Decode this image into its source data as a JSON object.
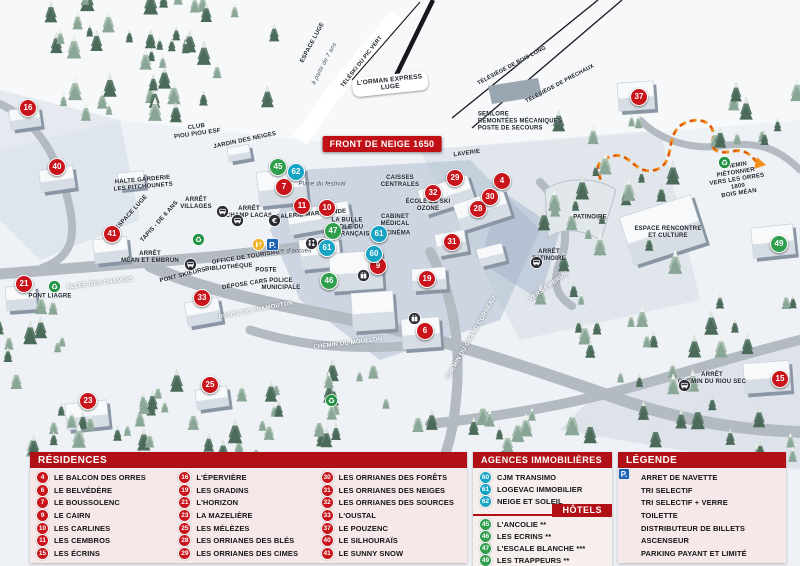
{
  "map": {
    "banner": "FRONT DE NEIGE 1650",
    "markers": [
      {
        "n": "16",
        "t": "r",
        "x": 28,
        "y": 108
      },
      {
        "n": "40",
        "t": "r",
        "x": 57,
        "y": 167
      },
      {
        "n": "41",
        "t": "r",
        "x": 112,
        "y": 234
      },
      {
        "n": "21",
        "t": "r",
        "x": 24,
        "y": 284
      },
      {
        "n": "33",
        "t": "r",
        "x": 202,
        "y": 298
      },
      {
        "n": "23",
        "t": "r",
        "x": 88,
        "y": 401
      },
      {
        "n": "25",
        "t": "r",
        "x": 210,
        "y": 385
      },
      {
        "n": "7",
        "t": "r",
        "x": 284,
        "y": 187
      },
      {
        "n": "11",
        "t": "r",
        "x": 302,
        "y": 206
      },
      {
        "n": "10",
        "t": "r",
        "x": 327,
        "y": 208
      },
      {
        "n": "9",
        "t": "r",
        "x": 378,
        "y": 266
      },
      {
        "n": "19",
        "t": "r",
        "x": 427,
        "y": 279
      },
      {
        "n": "6",
        "t": "r",
        "x": 425,
        "y": 331
      },
      {
        "n": "29",
        "t": "r",
        "x": 455,
        "y": 178
      },
      {
        "n": "32",
        "t": "r",
        "x": 433,
        "y": 193
      },
      {
        "n": "28",
        "t": "r",
        "x": 478,
        "y": 209
      },
      {
        "n": "30",
        "t": "r",
        "x": 490,
        "y": 197
      },
      {
        "n": "4",
        "t": "r",
        "x": 502,
        "y": 181
      },
      {
        "n": "31",
        "t": "r",
        "x": 452,
        "y": 242
      },
      {
        "n": "37",
        "t": "r",
        "x": 639,
        "y": 97
      },
      {
        "n": "15",
        "t": "r",
        "x": 780,
        "y": 379
      },
      {
        "n": "45",
        "t": "h",
        "x": 278,
        "y": 167
      },
      {
        "n": "47",
        "t": "h",
        "x": 333,
        "y": 231
      },
      {
        "n": "46",
        "t": "h",
        "x": 329,
        "y": 281
      },
      {
        "n": "49",
        "t": "h",
        "x": 779,
        "y": 244
      },
      {
        "n": "62",
        "t": "a",
        "x": 296,
        "y": 172
      },
      {
        "n": "61",
        "t": "a",
        "x": 379,
        "y": 234
      },
      {
        "n": "61",
        "t": "a",
        "x": 327,
        "y": 248
      },
      {
        "n": "60",
        "t": "a",
        "x": 374,
        "y": 254
      }
    ],
    "labels": [
      {
        "t": "CLUB\nPIOU PIOU ESF",
        "x": 197,
        "y": 131,
        "r": -8
      },
      {
        "t": "JARDIN DES NEIGES",
        "x": 245,
        "y": 141,
        "r": -12
      },
      {
        "t": "HALTE GARDERIE\nLES PITCHOUNETS",
        "x": 143,
        "y": 184,
        "r": -5
      },
      {
        "t": "ARRÊT\nVILLAGES",
        "x": 196,
        "y": 204,
        "r": 0
      },
      {
        "t": "ARRÊT\nCHAMP LACAS",
        "x": 249,
        "y": 213,
        "r": 0
      },
      {
        "t": "GALERIE MARCHANDE",
        "x": 311,
        "y": 215,
        "r": -5
      },
      {
        "t": "Place du festival",
        "x": 322,
        "y": 185,
        "r": 0,
        "c": "it"
      },
      {
        "t": "LA BULLE\nÉCOLE DU\nSKI FRANÇAIS",
        "x": 347,
        "y": 228,
        "r": 0
      },
      {
        "t": "CAISSES\nCENTRALES",
        "x": 400,
        "y": 182,
        "r": 0
      },
      {
        "t": "LAVERIE",
        "x": 467,
        "y": 154,
        "r": -8
      },
      {
        "t": "ÉCOLE DE SKI\nOZONE",
        "x": 428,
        "y": 206,
        "r": 0
      },
      {
        "t": "CABINET\nMÉDICAL",
        "x": 395,
        "y": 221,
        "r": 0
      },
      {
        "t": "CINÉMA",
        "x": 398,
        "y": 234,
        "r": 0
      },
      {
        "t": "OFFICE DE TOURISME",
        "x": 246,
        "y": 258,
        "r": -9
      },
      {
        "t": "BIBLIOTHÈQUE",
        "x": 229,
        "y": 268,
        "r": -5
      },
      {
        "t": "POSTE",
        "x": 266,
        "y": 271,
        "r": 0
      },
      {
        "t": "DÉPOSE CARS",
        "x": 245,
        "y": 285,
        "r": -9
      },
      {
        "t": "POLICE\nMUNICIPALE",
        "x": 281,
        "y": 285,
        "r": 0
      },
      {
        "t": "Place d'accueil",
        "x": 290,
        "y": 252,
        "r": 0,
        "c": "it"
      },
      {
        "t": "ARRÊT\nMÉAN ET EMBRUN",
        "x": 150,
        "y": 258,
        "r": 0
      },
      {
        "t": "PONT SKIEURS",
        "x": 183,
        "y": 276,
        "r": -14
      },
      {
        "t": "ALLÉE DES CHAMOIS",
        "x": 100,
        "y": 284,
        "r": -7,
        "c": "road"
      },
      {
        "t": "PONT LIAGRE",
        "x": 50,
        "y": 297,
        "r": 0
      },
      {
        "t": "ROUTE DE PRAMOUTON",
        "x": 256,
        "y": 311,
        "r": -11,
        "c": "road"
      },
      {
        "t": "CHEMIN DU MOUFLON",
        "x": 348,
        "y": 344,
        "r": -7,
        "c": "road"
      },
      {
        "t": "CHEMIN DU GRAND CORNEAU",
        "x": 472,
        "y": 338,
        "r": -60,
        "c": "road"
      },
      {
        "t": "VERS EMBRUN",
        "x": 549,
        "y": 287,
        "r": -36,
        "c": "road"
      },
      {
        "t": "PATINOIRE",
        "x": 590,
        "y": 218,
        "r": 0
      },
      {
        "t": "ARRÊT\nPATINOIRE",
        "x": 549,
        "y": 256,
        "r": 0
      },
      {
        "t": "ESPACE RENCONTRE\nET CULTURE",
        "x": 668,
        "y": 233,
        "r": 0
      },
      {
        "t": "CHEMIN PIÉTONNIER\nVERS LES ORRES 1800\nBOIS MÉAN",
        "x": 737,
        "y": 180,
        "r": -9
      },
      {
        "t": "ARRÊT\nCHEMIN DU RIOU SEC",
        "x": 712,
        "y": 379,
        "r": 0
      },
      {
        "t": "SEMLORE\nREMONTÉES MÉCANIQUES\nPOSTE DE SECOURS",
        "x": 520,
        "y": 122,
        "r": 0,
        "c": "left"
      },
      {
        "t": "TÉLÉSIÈGE DE BOIS LONG",
        "x": 512,
        "y": 66,
        "r": -28,
        "c": "lift"
      },
      {
        "t": "TÉLÉSIÈGE DE PRÉCHAUX",
        "x": 560,
        "y": 84,
        "r": -28,
        "c": "lift"
      },
      {
        "t": "TÉLÉSKI DU PIC VERT",
        "x": 362,
        "y": 62,
        "r": -52,
        "c": "lift"
      },
      {
        "t": "ESPACE LUGE",
        "x": 313,
        "y": 43,
        "r": -62
      },
      {
        "t": "à partir de 7 ans",
        "x": 325,
        "y": 64,
        "r": -62,
        "c": "it"
      },
      {
        "t": "ESPACE LUGE",
        "x": 132,
        "y": 213,
        "r": -48
      },
      {
        "t": "TAPIS - DE 6 ANS",
        "x": 160,
        "y": 222,
        "r": -48
      },
      {
        "t": "L'ORMAN EXPRESS\nLUGE",
        "x": 390,
        "y": 84,
        "r": -6,
        "c": "box"
      }
    ],
    "pois": [
      {
        "icon": "recycle",
        "x": 48,
        "y": 280
      },
      {
        "icon": "recycle",
        "x": 192,
        "y": 233
      },
      {
        "icon": "recycle",
        "x": 325,
        "y": 394
      },
      {
        "icon": "recycle",
        "x": 718,
        "y": 156
      },
      {
        "icon": "glass",
        "x": 252,
        "y": 238
      },
      {
        "icon": "parking",
        "x": 266,
        "y": 238
      },
      {
        "icon": "bus",
        "x": 216,
        "y": 205
      },
      {
        "icon": "bus",
        "x": 231,
        "y": 214
      },
      {
        "icon": "bus",
        "x": 184,
        "y": 258
      },
      {
        "icon": "bus",
        "x": 530,
        "y": 256
      },
      {
        "icon": "bus",
        "x": 678,
        "y": 379
      },
      {
        "icon": "toilet",
        "x": 305,
        "y": 237
      },
      {
        "icon": "elevator",
        "x": 317,
        "y": 238
      },
      {
        "icon": "elevator",
        "x": 357,
        "y": 269
      },
      {
        "icon": "elevator",
        "x": 408,
        "y": 312
      },
      {
        "icon": "atm",
        "x": 268,
        "y": 214
      }
    ]
  },
  "legend": {
    "residences": {
      "title": "RÉSIDENCES",
      "items": [
        {
          "n": "4",
          "label": "LE BALCON DES ORRES"
        },
        {
          "n": "6",
          "label": "LE BELVÉDÈRE"
        },
        {
          "n": "7",
          "label": "LE BOUSSOLENC"
        },
        {
          "n": "9",
          "label": "LE CAIRN"
        },
        {
          "n": "10",
          "label": "LES CARLINES"
        },
        {
          "n": "11",
          "label": "LES CEMBROS"
        },
        {
          "n": "15",
          "label": "LES ÉCRINS"
        },
        {
          "n": "16",
          "label": "L'ÉPERVIÈRE"
        },
        {
          "n": "19",
          "label": "LES GRADINS"
        },
        {
          "n": "21",
          "label": "L'HORIZON"
        },
        {
          "n": "23",
          "label": "LA MAZELIÈRE"
        },
        {
          "n": "25",
          "label": "LES MÉLÈZES"
        },
        {
          "n": "28",
          "label": "LES ORRIANES DES BLÉS"
        },
        {
          "n": "29",
          "label": "LES ORRIANES DES CIMES"
        },
        {
          "n": "30",
          "label": "LES ORRIANES DES FORÊTS"
        },
        {
          "n": "31",
          "label": "LES ORRIANES DES NEIGES"
        },
        {
          "n": "32",
          "label": "LES ORRIANES DES SOURCES"
        },
        {
          "n": "33",
          "label": "L'OUSTAL"
        },
        {
          "n": "37",
          "label": "LE POUZENC"
        },
        {
          "n": "40",
          "label": "LE SILHOURAÏS"
        },
        {
          "n": "41",
          "label": "LE SUNNY SNOW"
        }
      ]
    },
    "agences": {
      "title": "AGENCES IMMOBILIÈRES",
      "items": [
        {
          "n": "60",
          "label": "CJM TRANSIMO"
        },
        {
          "n": "61",
          "label": "LOGEVAC IMMOBILIER"
        },
        {
          "n": "62",
          "label": "NEIGE ET SOLEIL"
        }
      ]
    },
    "hotels": {
      "title": "HÔTELS",
      "items": [
        {
          "n": "45",
          "label": "L'ANCOLIE **"
        },
        {
          "n": "46",
          "label": "LES ECRINS **"
        },
        {
          "n": "47",
          "label": "L'ESCALE BLANCHE ***"
        },
        {
          "n": "49",
          "label": "LES TRAPPEURS **"
        }
      ]
    },
    "legende": {
      "title": "LÉGENDE",
      "items": [
        {
          "icon": "bus",
          "label": "ARRET DE NAVETTE"
        },
        {
          "icon": "recycle",
          "label": "TRI SELECTIF"
        },
        {
          "icon": "glass",
          "label": "TRI SELECTIF + VERRE"
        },
        {
          "icon": "toilet",
          "label": "TOILETTE"
        },
        {
          "icon": "atm",
          "label": "DISTRIBUTEUR DE BILLETS"
        },
        {
          "icon": "elevator",
          "label": "ASCENSEUR"
        },
        {
          "icon": "parking",
          "label": "PARKING PAYANT ET LIMITÉ"
        }
      ]
    }
  },
  "colors": {
    "marker_red": "#c8141a",
    "marker_green": "#2f9e4d",
    "marker_blue": "#17a3c4",
    "header_red": "#b11116",
    "path_orange": "#ef8f1c"
  }
}
